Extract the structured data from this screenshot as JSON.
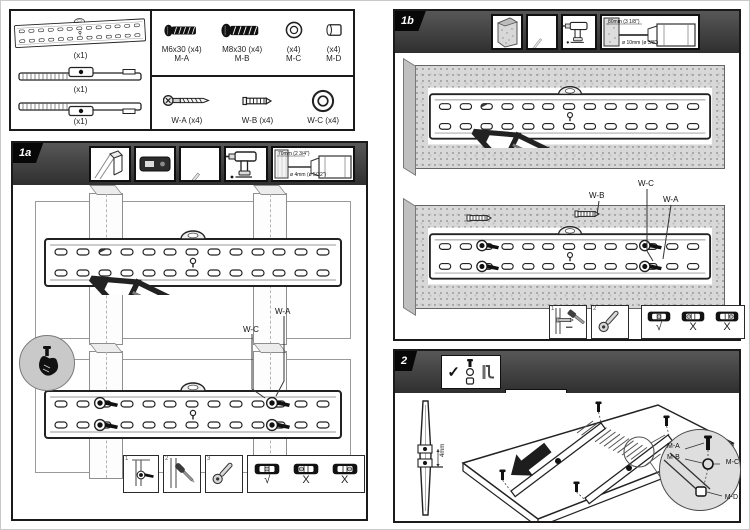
{
  "parts": {
    "rails": [
      {
        "qty": "(x1)"
      },
      {
        "qty": "(x1)"
      },
      {
        "qty": "(x1)"
      }
    ],
    "hardware_m": [
      {
        "spec": "M6x30 (x4)",
        "code": "M-A"
      },
      {
        "spec": "M8x30 (x4)",
        "code": "M-B"
      },
      {
        "spec": "(x4)",
        "code": "M-C"
      },
      {
        "spec": "(x4)",
        "code": "M-D"
      }
    ],
    "hardware_w": [
      {
        "label": "W-A (x4)"
      },
      {
        "label": "W-B (x4)"
      },
      {
        "label": "W-C (x4)"
      }
    ]
  },
  "panel1a": {
    "id": "1a",
    "drill_depth": "70mm (2 3/4\")",
    "drill_dia": "ø 4mm (ø 5/32\")",
    "callout_wa": "W-A",
    "callout_wc": "W-C",
    "step1": "1",
    "step2": "2",
    "step3": "3",
    "level_ok": "√",
    "level_x1": "X",
    "level_x2": "X"
  },
  "panel1b": {
    "id": "1b",
    "drill_depth": "80mm (3 1/8\")",
    "drill_dia": "ø 10mm (ø 3/8\")",
    "callout_wb": "W-B",
    "callout_wc": "W-C",
    "callout_wa": "W-A",
    "step1": "1",
    "step2": "2",
    "level_ok": "√",
    "level_x1": "X",
    "level_x2": "X"
  },
  "panel2": {
    "id": "2",
    "check": "✓",
    "cross": "✗",
    "callout_ma": "M-A",
    "callout_mb": "M-B",
    "callout_mc": "M-C",
    "callout_md": "M-D",
    "dim": "4mm"
  }
}
